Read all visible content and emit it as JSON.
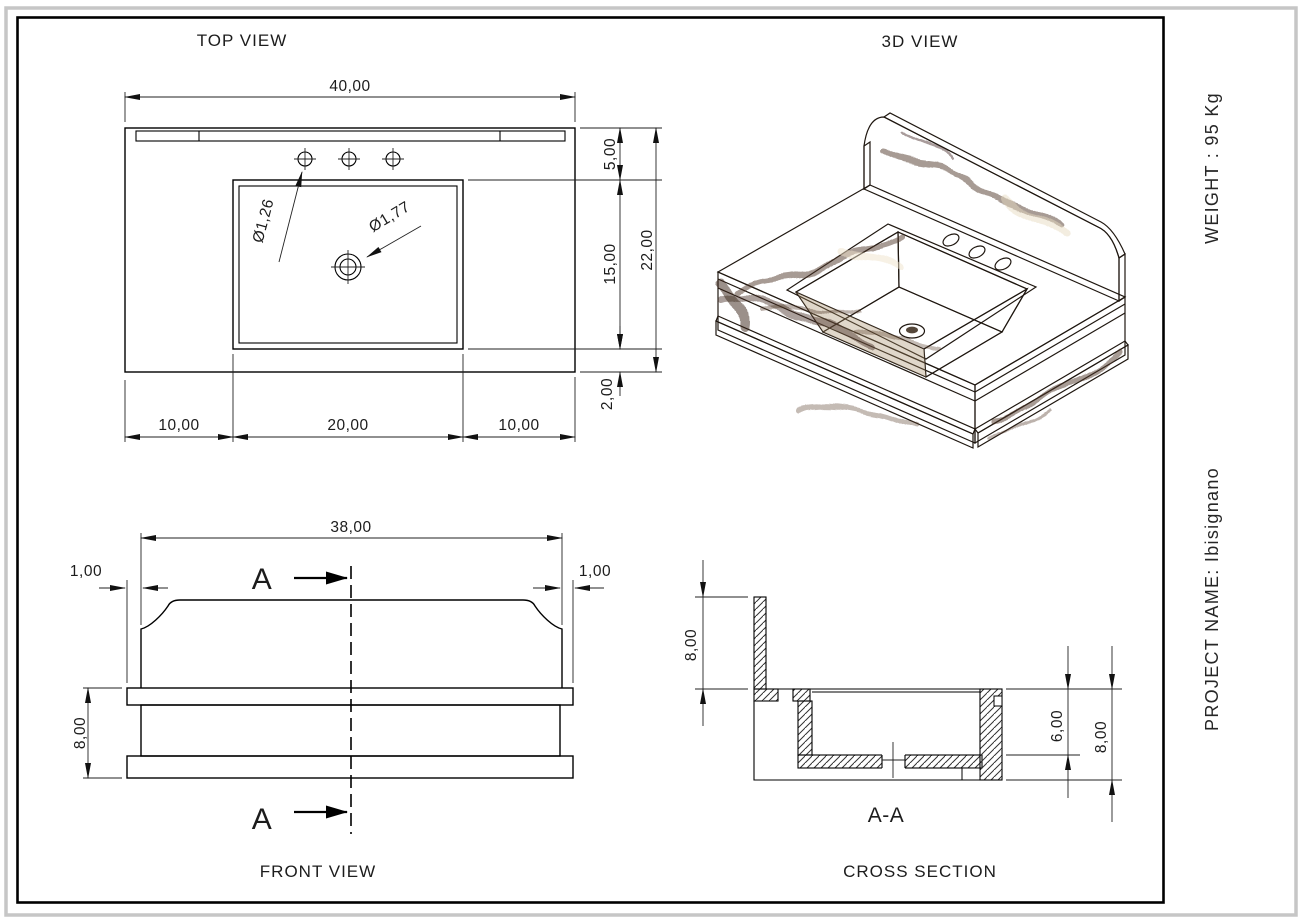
{
  "labels": {
    "top_view": "TOP VIEW",
    "three_d_view": "3D VIEW",
    "front_view": "FRONT VIEW",
    "cross_section": "CROSS SECTION",
    "section": "A-A",
    "section_marker_top": "A",
    "section_marker_bottom": "A"
  },
  "sidebar": {
    "weight": "WEIGHT : 95 Kg",
    "project": "PROJECT NAME: Ibisignano"
  },
  "top_view": {
    "width_total": "40,00",
    "back_offset": "5,00",
    "sink_depth": "15,00",
    "depth_total": "22,00",
    "front_offset": "2,00",
    "left_margin": "10,00",
    "sink_width": "20,00",
    "right_margin": "10,00",
    "faucet_dia": "Ø1,26",
    "drain_dia": "Ø1,77"
  },
  "front_view": {
    "splash_width": "38,00",
    "left_inset": "1,00",
    "right_inset": "1,00",
    "height": "8,00"
  },
  "cross_section": {
    "splash_height": "8,00",
    "bowl_depth": "6,00",
    "height": "8,00"
  },
  "colors": {
    "frame": "#000000",
    "page_border": "#c6c6c6",
    "marble_dark_vein": "#4d3527",
    "marble_base": "#b99f7e",
    "marble_light": "#e3d5ba"
  }
}
